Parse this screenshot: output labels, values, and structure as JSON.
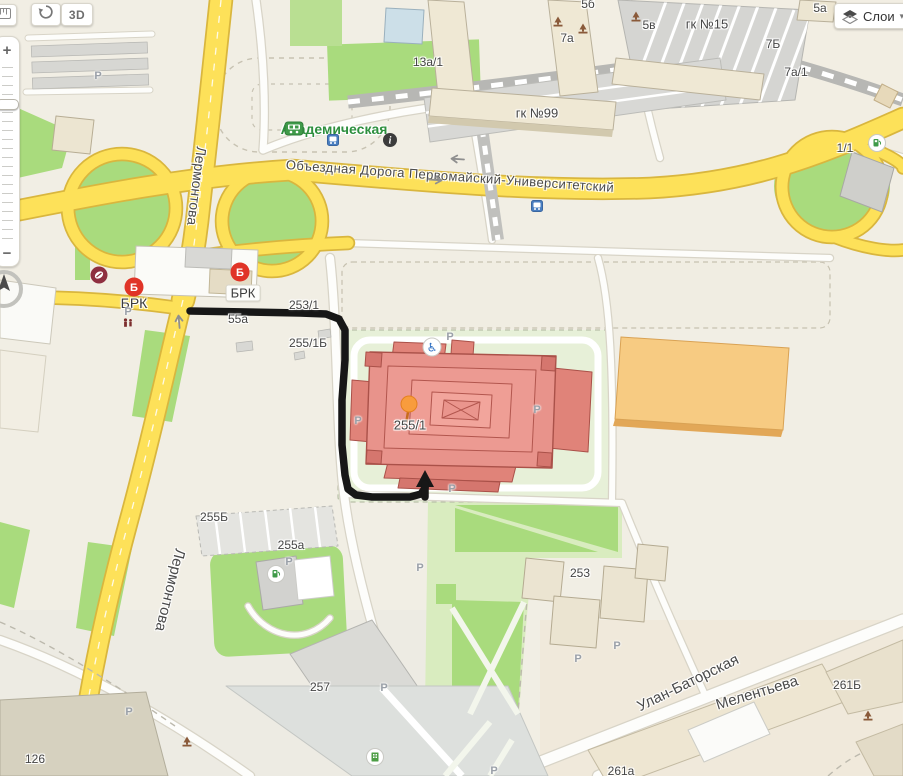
{
  "ui": {
    "view_3d": {
      "label": "3D"
    },
    "layers": {
      "label": "Слои",
      "caret": "▾",
      "icon": "layers-icon"
    },
    "zoom": {
      "plus": "+",
      "minus": "−"
    },
    "toolbar_icons": [
      "ruler-icon",
      "rotate-view-icon"
    ],
    "compass_icon": "compass-north-icon"
  },
  "colors": {
    "route": "#171717",
    "pin": "#f89c3d",
    "road_yellow": "#fde159",
    "lawn_green": "#a9db7d",
    "highlight_building": "#e8938b",
    "brk_red": "#e03427",
    "station_green": "#2e8f3e"
  },
  "map": {
    "labels": [
      {
        "text": "13а/1",
        "x": 428,
        "y": 62
      },
      {
        "text": "7а",
        "x": 567,
        "y": 38
      },
      {
        "text": "5в",
        "x": 649,
        "y": 25
      },
      {
        "text": "5б",
        "x": 588,
        "y": 4
      },
      {
        "text": "гк №15",
        "x": 707,
        "y": 24,
        "size": 13
      },
      {
        "text": "7Б",
        "x": 773,
        "y": 44
      },
      {
        "text": "7а/1",
        "x": 796,
        "y": 72
      },
      {
        "text": "5а",
        "x": 820,
        "y": 8
      },
      {
        "text": "гк №99",
        "x": 537,
        "y": 113,
        "size": 13
      },
      {
        "text": "1/1",
        "x": 845,
        "y": 148
      },
      {
        "text": "Академическая",
        "x": 334,
        "y": 129,
        "size": 14,
        "color": "#2e8f3e",
        "weight": 700
      },
      {
        "text": "Объездная Дорога Первомайский-Университетский",
        "x": 450,
        "y": 176,
        "rot": 4,
        "size": 13,
        "color": "#4a4a4a",
        "ls": 0.4
      },
      {
        "text": "Лермонтова",
        "x": 197,
        "y": 186,
        "rot": 97,
        "size": 14,
        "color": "#4a4a4a"
      },
      {
        "text": "Лермонтова",
        "x": 170,
        "y": 590,
        "rot": 104,
        "size": 15,
        "color": "#4a4a4a"
      },
      {
        "text": "Улан-Баторская",
        "x": 688,
        "y": 683,
        "rot": -26,
        "size": 15,
        "color": "#4a4a4a"
      },
      {
        "text": "Мелентьева",
        "x": 757,
        "y": 693,
        "rot": -17,
        "size": 15,
        "color": "#4a4a4a"
      },
      {
        "text": "261Б",
        "x": 847,
        "y": 685
      },
      {
        "text": "261а",
        "x": 621,
        "y": 771
      },
      {
        "text": "126",
        "x": 35,
        "y": 759
      },
      {
        "text": "257",
        "x": 320,
        "y": 687
      },
      {
        "text": "253",
        "x": 580,
        "y": 573
      },
      {
        "text": "255Б",
        "x": 214,
        "y": 517
      },
      {
        "text": "255а",
        "x": 291,
        "y": 545
      },
      {
        "text": "253/1",
        "x": 304,
        "y": 305
      },
      {
        "text": "255/1Б",
        "x": 308,
        "y": 343
      },
      {
        "text": "55а",
        "x": 238,
        "y": 319
      },
      {
        "text": "255/1",
        "x": 410,
        "y": 425,
        "size": 13
      },
      {
        "text": "БРК",
        "x": 134,
        "y": 303,
        "size": 14,
        "color": "#3c3c3c"
      },
      {
        "text": "БРК",
        "x": 243,
        "y": 293,
        "size": 13,
        "color": "#3c3c3c",
        "chip": true
      }
    ],
    "parking": {
      "letter": "P",
      "positions": [
        [
          98,
          76
        ],
        [
          128,
          312
        ],
        [
          450,
          337
        ],
        [
          358,
          421
        ],
        [
          537,
          410
        ],
        [
          452,
          489
        ],
        [
          289,
          562
        ],
        [
          420,
          568
        ],
        [
          617,
          646
        ],
        [
          578,
          659
        ],
        [
          384,
          688
        ],
        [
          129,
          712
        ],
        [
          494,
          771
        ]
      ]
    },
    "icons": [
      {
        "name": "brk-logo",
        "x": 134,
        "y": 287
      },
      {
        "name": "brk-logo",
        "x": 240,
        "y": 272
      },
      {
        "name": "coffee-poi",
        "x": 99,
        "y": 275
      },
      {
        "name": "fuel-poi",
        "x": 877,
        "y": 143
      },
      {
        "name": "fuel-poi",
        "x": 276,
        "y": 574
      },
      {
        "name": "organization-poi",
        "x": 375,
        "y": 757
      },
      {
        "name": "railway-station",
        "x": 294,
        "y": 129
      },
      {
        "name": "info-poi",
        "x": 390,
        "y": 140
      },
      {
        "name": "bus-stop",
        "x": 333,
        "y": 140
      },
      {
        "name": "bus-stop",
        "x": 537,
        "y": 206
      },
      {
        "name": "monument-poi",
        "x": 558,
        "y": 22
      },
      {
        "name": "monument-poi",
        "x": 583,
        "y": 29
      },
      {
        "name": "monument-poi",
        "x": 636,
        "y": 17
      },
      {
        "name": "monument-poi",
        "x": 187,
        "y": 742
      },
      {
        "name": "monument-poi",
        "x": 868,
        "y": 716
      },
      {
        "name": "market-poi",
        "x": 128,
        "y": 323
      },
      {
        "name": "wheelchair-access",
        "x": 432,
        "y": 347,
        "clickable": false
      },
      {
        "name": "one-way-arrow",
        "x": 179,
        "y": 321,
        "rot": -95,
        "clickable": false
      },
      {
        "name": "one-way-arrow",
        "x": 457,
        "y": 159,
        "rot": 184,
        "clickable": false
      },
      {
        "name": "one-way-arrow",
        "x": 436,
        "y": 180,
        "rot": 4,
        "clickable": false
      }
    ],
    "route": {
      "color": "#171717",
      "points": [
        [
          190,
          311
        ],
        [
          300,
          313
        ],
        [
          326,
          314
        ],
        [
          339,
          319
        ],
        [
          345,
          330
        ],
        [
          345,
          360
        ],
        [
          342,
          400
        ],
        [
          342,
          445
        ],
        [
          345,
          475
        ],
        [
          348,
          489
        ],
        [
          356,
          495
        ],
        [
          372,
          497
        ],
        [
          410,
          497
        ],
        [
          421,
          494
        ],
        [
          425,
          488
        ],
        [
          425,
          483
        ]
      ],
      "arrow": [
        [
          425,
          470
        ],
        [
          416,
          487
        ],
        [
          434,
          487
        ]
      ]
    },
    "placemark": {
      "label": "255/1"
    }
  }
}
